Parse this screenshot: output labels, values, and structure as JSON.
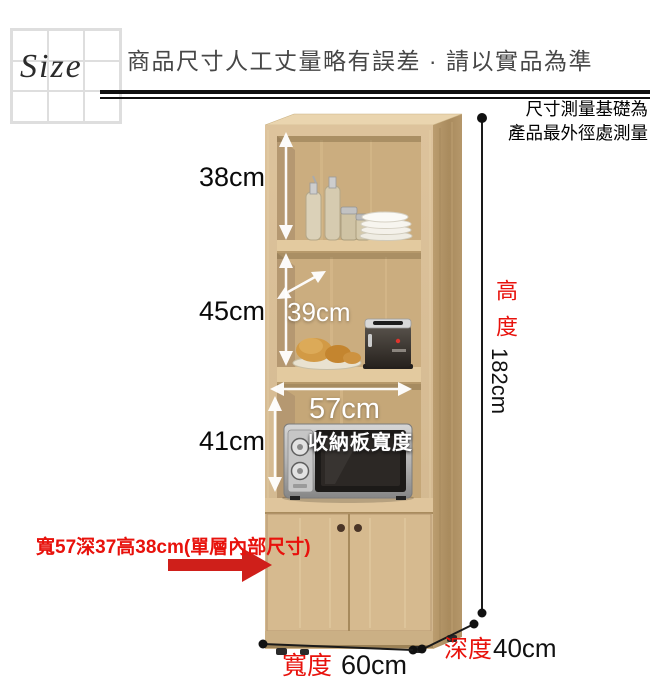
{
  "header": {
    "logo_text": "Size",
    "title": "商品尺寸人工丈量略有誤差 · 請以實品為準"
  },
  "measurement_note": {
    "line1": "尺寸測量基礎為",
    "line2": "產品最外徑處測量"
  },
  "labels": {
    "shelf1_height": "38cm",
    "shelf2_height": "45cm",
    "shelf2_depth": "39cm",
    "shelf3_height": "41cm",
    "board_width": "57cm",
    "board_width_caption": "收納板寬度",
    "height_label": "高度",
    "height_value": "182cm",
    "width_label": "寬度",
    "width_value": "60cm",
    "depth_label": "深度",
    "depth_value": "40cm",
    "inner_dims_note": "寬57深37高38cm(單層內部尺寸)"
  },
  "colors": {
    "accent_red": "#e8120c",
    "arrow_red": "#cf1f1a",
    "wood_front": "#d8be97",
    "wood_side": "#ac8f62",
    "wood_interior": "#cbad7f",
    "line_black": "#1a1a1a"
  }
}
